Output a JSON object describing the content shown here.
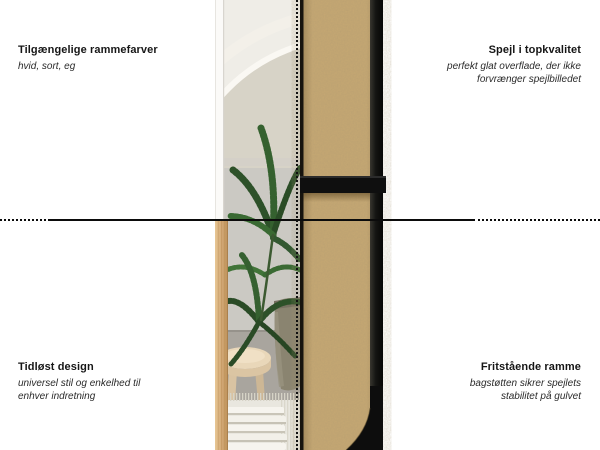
{
  "annotations": {
    "top_left": {
      "title": "Tilgængelige rammefarver",
      "subtitle": "hvid, sort, eg"
    },
    "top_right": {
      "title": "Spejl i topkvalitet",
      "subtitle": "perfekt glat overflade, der ikke\nforvrænger spejlbilledet"
    },
    "bottom_left": {
      "title": "Tidløst design",
      "subtitle": "universel stil og enkelhed til\nenhver indretning"
    },
    "bottom_right": {
      "title": "Fritstående ramme",
      "subtitle": "bagstøtten sikrer spejlets\nstabilitet på gulvet"
    }
  },
  "colors": {
    "background": "#ffffff",
    "text": "#1d1d1d",
    "guide_line": "#0b0b0b",
    "mdf_board": "#c6a873",
    "frame_black": "#131313",
    "oak_frame_sample": "#d3a976",
    "white_frame_sample": "#fbfaf8",
    "palm_green": "#2d5129"
  }
}
